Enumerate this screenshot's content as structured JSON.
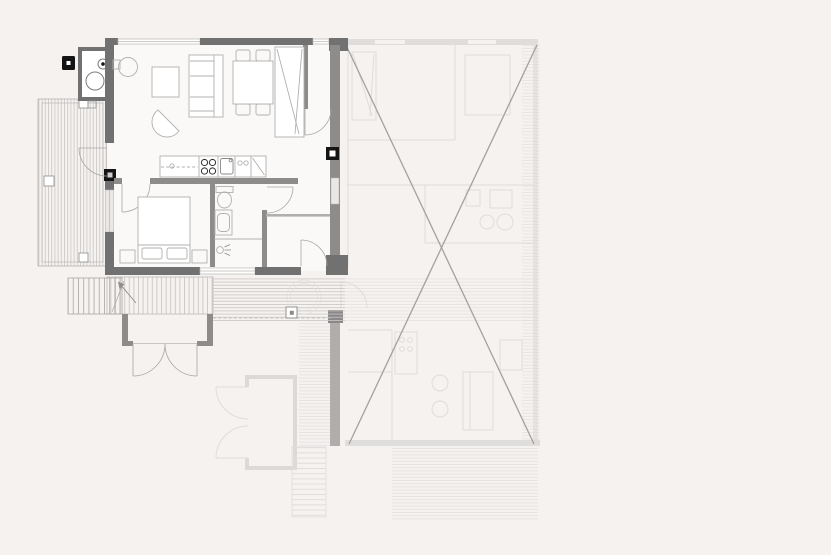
{
  "drawing": {
    "kind": "floor-plan",
    "units": {
      "active_unit": "left apartment (drawn solid)",
      "excluded_unit": "right apartment (ghosted, crossed out with X)"
    },
    "fixture_icons": [
      "washer-icon",
      "water-heater-icon",
      "chimney-icon",
      "wood-stove-icon",
      "coffee-table-icon",
      "sofa-icon",
      "armchair-icon",
      "dining-table-icon",
      "chair-icon",
      "wardrobe-icon",
      "kitchen-counter-icon",
      "cooktop-icon",
      "kitchen-sink-icon",
      "toilet-icon",
      "bathroom-sink-icon",
      "shower-drain-icon",
      "double-bed-icon",
      "nightstand-icon",
      "pillow-icon",
      "door-swing-icon",
      "stairs-icon",
      "stair-direction-arrow-icon",
      "deck-boards-hatch",
      "column-post-icon",
      "hot-tub-icon",
      "excluded-area-x-mark"
    ]
  },
  "palette": {
    "background": "#f5f2f0",
    "floor": "#fbf9f8",
    "wall_dark": "#717171",
    "wall_medium": "#8e8c8b",
    "wall_light": "#b9b7b6",
    "furniture_line": "#b2b0af",
    "fixture_dark": "#2e2e2e",
    "black_post": "#141414",
    "deck_line": "#c9c7c5",
    "ghost_line": "#dfdddc",
    "ghost_wall": "#dcdad9",
    "x_mark": "#a3a1a0"
  }
}
